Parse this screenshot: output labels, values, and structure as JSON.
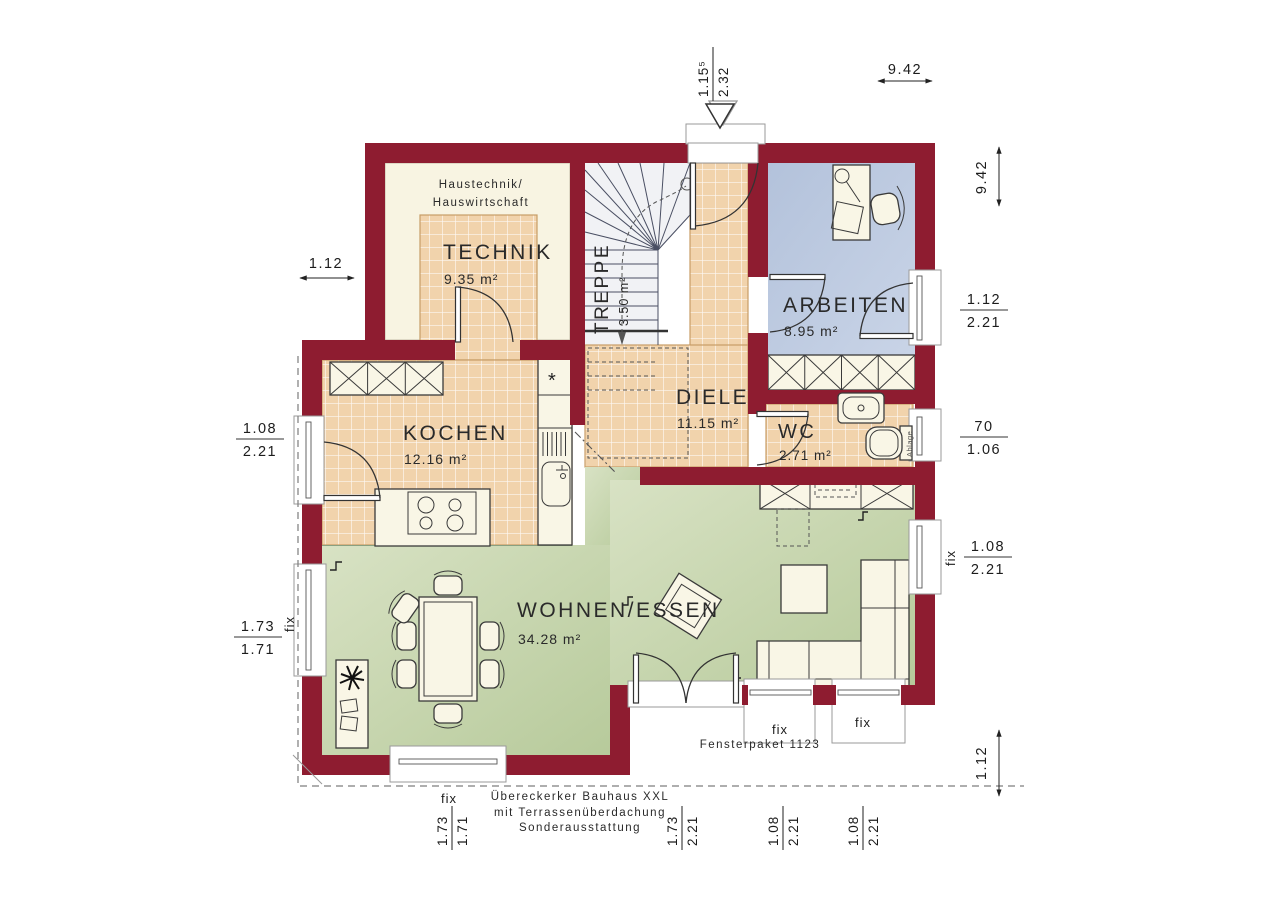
{
  "plan": {
    "rooms": {
      "technik": {
        "note1": "Haustechnik/",
        "note2": "Hauswirtschaft",
        "name": "TECHNIK",
        "area": "9.35 m²"
      },
      "treppe": {
        "name": "TREPPE",
        "area": "3.50 m²"
      },
      "diele": {
        "name": "DIELE",
        "area": "11.15 m²"
      },
      "arbeiten": {
        "name": "ARBEITEN",
        "area": "8.95 m²"
      },
      "wc": {
        "name": "WC",
        "area": "2.71 m²",
        "shelf_label": "Ablage"
      },
      "kochen": {
        "name": "KOCHEN",
        "area": "12.16 m²"
      },
      "wohnen": {
        "name": "WOHNEN/ESSEN",
        "area": "34.28 m²"
      }
    },
    "symbols": {
      "fridge_star": "*"
    },
    "dimensions": {
      "top_width": "9.42",
      "right_height": "9.42",
      "left_upper": "1.12",
      "bottom_right": "1.12",
      "entry_door": {
        "w": "1.15⁵",
        "h": "2.32"
      },
      "right_window_arbeiten": {
        "w": "1.12",
        "h": "2.21"
      },
      "right_window_wc": {
        "w": "70",
        "h": "1.06"
      },
      "right_window_wohnen": {
        "w": "1.08",
        "h": "2.21",
        "fix": "fix"
      },
      "left_door_kochen": {
        "w": "1.08",
        "h": "2.21"
      },
      "left_window_wohnen": {
        "w": "1.73",
        "h": "1.71",
        "fix": "fix"
      },
      "bottom_window_left": {
        "fix": "fix",
        "w": "1.73",
        "h": "1.71"
      },
      "bottom_terrace_door": {
        "w": "1.73",
        "h": "2.21"
      },
      "bottom_window_mid": {
        "fix": "fix",
        "w": "1.08",
        "h": "2.21"
      },
      "bottom_window_right": {
        "fix": "fix",
        "w": "1.08",
        "h": "2.21"
      }
    },
    "notes": {
      "fensterpaket": "Fensterpaket 1123",
      "footer1": "Übereckerker Bauhaus XXL",
      "footer2": "mit Terrassenüberdachung",
      "footer3": "Sonderausstattung"
    },
    "colors": {
      "wall": "#8e1c30",
      "tile": "#f1d3ac",
      "living_green": "#c3d4a7",
      "office_blue": "#b7c6dd",
      "cabinet_cream": "#f8f4e2"
    }
  }
}
